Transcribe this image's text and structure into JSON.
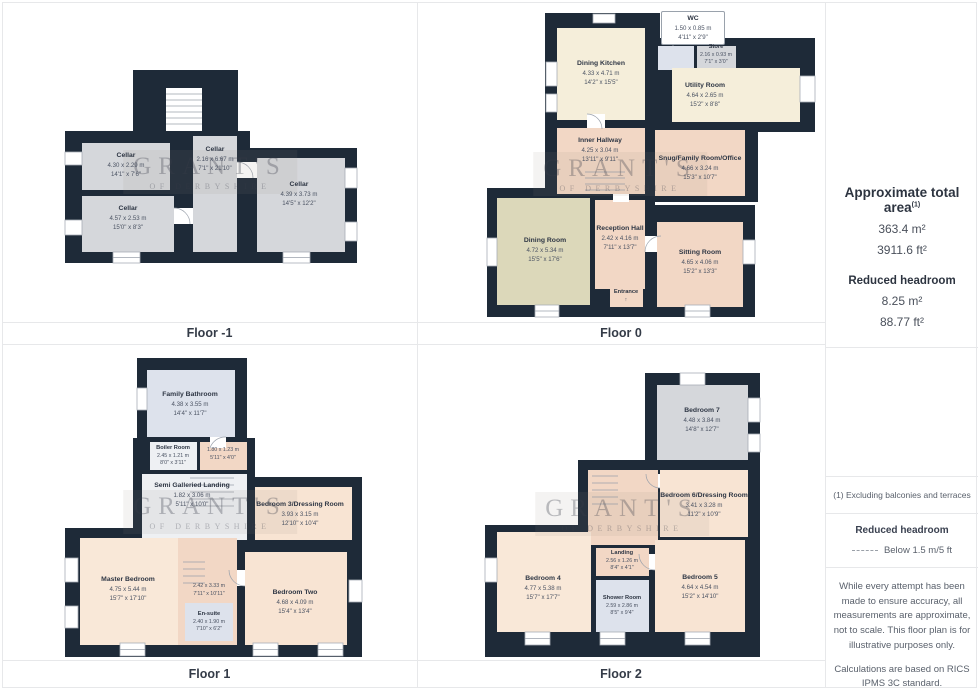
{
  "watermark": {
    "line1": "GRANT'S",
    "line2": "OF DERBYSHIRE"
  },
  "colors": {
    "wall": "#1e2a38",
    "cellar": "#d5d7db",
    "cream": "#f5eeda",
    "pink": "#f2d7c5",
    "peach": "#f8e4d3",
    "khaki": "#dcd8ba",
    "bath_blue": "#dde2ec",
    "border": "#e7e8ea"
  },
  "floors": [
    {
      "caption": "Floor -1",
      "rooms": [
        {
          "name": "Cellar",
          "m": "4.30 x 2.29 m",
          "ft": "14'1\" x 7'6\""
        },
        {
          "name": "Cellar",
          "m": "4.57 x 2.53 m",
          "ft": "15'0\" x 8'3\""
        },
        {
          "name": "Cellar",
          "m": "2.16 x 6.67 m",
          "ft": "7'1\" x 21'10\""
        },
        {
          "name": "Cellar",
          "m": "4.39 x 3.73 m",
          "ft": "14'5\" x 12'2\""
        }
      ]
    },
    {
      "caption": "Floor 0",
      "wc": {
        "name": "WC",
        "m": "1.50 x 0.85 m",
        "ft": "4'11\" x 2'9\""
      },
      "entrance": "Entrance",
      "entrance_arrow": "↑",
      "rooms": [
        {
          "name": "Dining Kitchen",
          "m": "4.33 x 4.71 m",
          "ft": "14'2\" x 15'5\""
        },
        {
          "name": "Store",
          "m": "2.16 x 0.93 m",
          "ft": "7'1\" x 3'0\""
        },
        {
          "name": "Utility Room",
          "m": "4.64 x 2.65 m",
          "ft": "15'2\" x 8'8\""
        },
        {
          "name": "Inner Hallway",
          "m": "4.25 x 3.04 m",
          "ft": "13'11\" x 9'11\""
        },
        {
          "name": "Snug/Family Room/Office",
          "m": "4.66 x 3.24 m",
          "ft": "15'3\" x 10'7\""
        },
        {
          "name": "Dining Room",
          "m": "4.72 x 5.34 m",
          "ft": "15'5\" x 17'6\""
        },
        {
          "name": "Reception Hall",
          "m": "2.42 x 4.16 m",
          "ft": "7'11\" x 13'7\""
        },
        {
          "name": "Sitting Room",
          "m": "4.65 x 4.06 m",
          "ft": "15'2\" x 13'3\""
        }
      ]
    },
    {
      "caption": "Floor 1",
      "rooms": [
        {
          "name": "Family Bathroom",
          "m": "4.38 x 3.55 m",
          "ft": "14'4\" x 11'7\""
        },
        {
          "name": "Boiler Room",
          "m": "2.45 x 1.21 m",
          "ft": "8'0\" x 3'11\""
        },
        {
          "m": "1.80 x 1.23 m",
          "ft": "5'11\" x 4'0\""
        },
        {
          "name": "Semi Galleried Landing",
          "m": "1.82 x 3.06 m",
          "ft": "5'11\" x 10'0\""
        },
        {
          "name": "Bedroom 3/Dressing Room",
          "m": "3.93 x 3.15 m",
          "ft": "12'10\" x 10'4\""
        },
        {
          "name": "Master Bedroom",
          "m": "4.75 x 5.44 m",
          "ft": "15'7\" x 17'10\""
        },
        {
          "m": "2.42 x 3.33 m",
          "ft": "7'11\" x 10'11\""
        },
        {
          "name": "En-suite",
          "m": "2.40 x 1.90 m",
          "ft": "7'10\" x 6'2\""
        },
        {
          "name": "Bedroom Two",
          "m": "4.68 x 4.09 m",
          "ft": "15'4\" x 13'4\""
        }
      ]
    },
    {
      "caption": "Floor 2",
      "rooms": [
        {
          "name": "Bedroom 7",
          "m": "4.48 x 3.84 m",
          "ft": "14'8\" x 12'7\""
        },
        {
          "name": "Bedroom 6/Dressing Room",
          "m": "3.41 x 3.28 m",
          "ft": "11'2\" x 10'9\""
        },
        {
          "name": "Landing",
          "m": "2.56 x 1.26 m",
          "ft": "8'4\" x 4'1\""
        },
        {
          "name": "Bedroom 4",
          "m": "4.77 x 5.38 m",
          "ft": "15'7\" x 17'7\""
        },
        {
          "name": "Shower Room",
          "m": "2.59 x 2.86 m",
          "ft": "8'5\" x 9'4\""
        },
        {
          "name": "Bedroom 5",
          "m": "4.64 x 4.54 m",
          "ft": "15'2\" x 14'10\""
        }
      ]
    }
  ],
  "sidebar": {
    "area_title": "Approximate total area",
    "area_note_ref": "(1)",
    "area_m2": "363.4 m²",
    "area_ft2": "3911.6 ft²",
    "rh_title": "Reduced headroom",
    "rh_m2": "8.25 m²",
    "rh_ft2": "88.77 ft²",
    "note": "(1) Excluding balconies and terraces",
    "legend_title": "Reduced headroom",
    "legend_item": "Below 1.5 m/5 ft",
    "disclaimer": "While every attempt has been made to ensure accuracy, all measurements are approximate, not to scale. This floor plan is for illustrative purposes only.",
    "standard": "Calculations are based on RICS IPMS 3C standard.",
    "brand1": "GIRAFFE",
    "brand2": "360"
  }
}
